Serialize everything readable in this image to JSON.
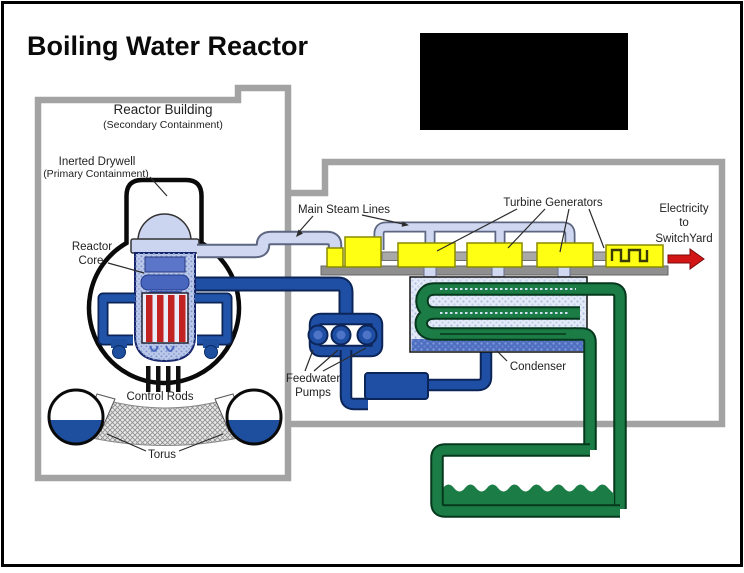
{
  "title": "Boiling Water Reactor",
  "labels": {
    "reactor_building": "Reactor Building",
    "reactor_building_sub": "(Secondary Containment)",
    "inerted_drywell": "Inerted Drywell",
    "inerted_drywell_sub": "(Primary Containment)",
    "reactor_core_line1": "Reactor",
    "reactor_core_line2": "Core",
    "control_rods": "Control Rods",
    "torus": "Torus",
    "main_steam_lines": "Main Steam Lines",
    "turbine_generators": "Turbine Generators",
    "electricity_line1": "Electricity",
    "electricity_line2": "to",
    "electricity_line3": "SwitchYard",
    "feedwater_line1": "Feedwater",
    "feedwater_line2": "Pumps",
    "condenser": "Condenser"
  },
  "palette": {
    "wall": "#a3a3a3",
    "steam": "#cfd8f0",
    "blue": "#1f4fa4",
    "green": "#1c7c45",
    "yellow": "#ffff14",
    "red": "#d21616",
    "rod": "#c32222",
    "periwinkle": "#ccd5f0"
  }
}
